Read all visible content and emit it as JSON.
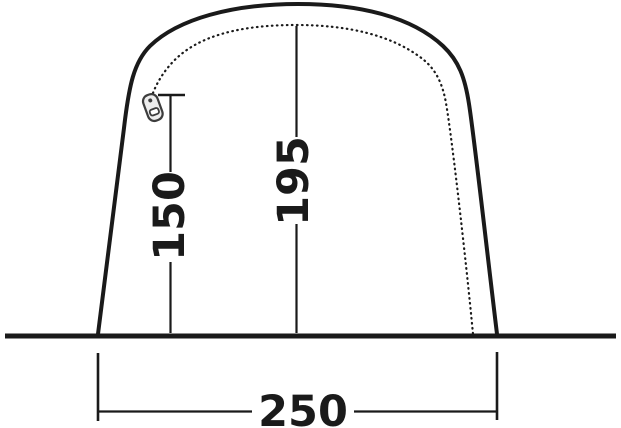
{
  "diagram": {
    "dimensions": {
      "side_height": "150",
      "center_height": "195",
      "base_width": "250"
    },
    "icons": {
      "zipper": "zipper-pull-icon"
    },
    "colors": {
      "line": "#1a1a1a",
      "background": "#ffffff",
      "zipper_outline": "#3d3d3d",
      "zipper_fill": "#ededed"
    }
  }
}
